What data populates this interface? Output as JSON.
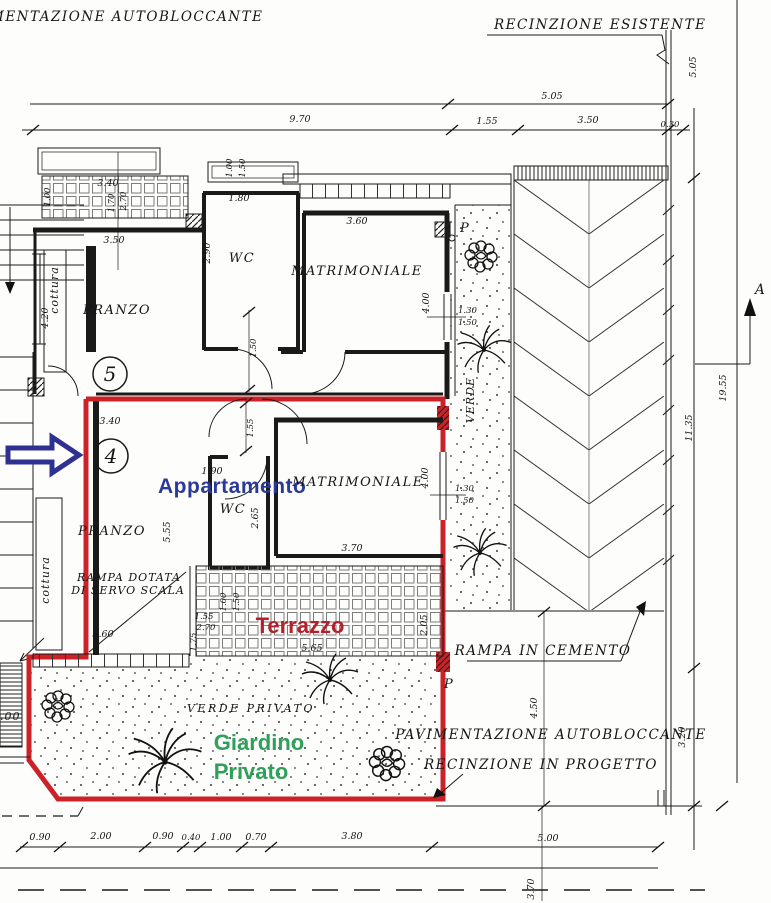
{
  "annotations": {
    "pavimentazione_top": "MENTAZIONE  AUTOBLOCCANTE",
    "recinzione_esistente": "RECINZIONE  ESISTENTE",
    "rampa_cemento": "RAMPA IN CEMENTO",
    "pavimentazione_autobloccante": "PAVIMENTAZIONE  AUTOBLOCCANTE",
    "recinzione_progetto": "RECINZIONE IN PROGETTO",
    "verde_privato": "VERDE  PRIVATO",
    "section_a": "A"
  },
  "apartment5": {
    "number": "5",
    "pranzo": "PRANZO",
    "wc": "WC",
    "matrimoniale": "MATRIMONIALE",
    "cottura": "cottura"
  },
  "apartment4": {
    "number": "4",
    "name": "Appartamento",
    "pranzo": "PRANZO",
    "wc": "WC",
    "matrimoniale": "MATRIMONIALE",
    "cottura": "cottura",
    "rampa1": "RAMPA DOTATA",
    "rampa2": "DI SERVO SCALA",
    "terrazzo": "Terrazzo",
    "giardino1": "Giardino",
    "giardino2": "Privato"
  },
  "markers": {
    "p": "P",
    "verde": "VERDE"
  },
  "dims": {
    "d030": "0.30",
    "d040": "0.40",
    "d070": "0.70",
    "d090": "0.90",
    "d100": "1.00",
    "d130": "1.30",
    "d150": "1.50",
    "d155": "1.55",
    "d170": "1.70",
    "d175": "1.75",
    "d180": "1.80",
    "d190": "1.90",
    "d200": "2.00",
    "d205": "2.05",
    "d265": "2.65",
    "d270": "2.70",
    "d290": "2.90",
    "d320": "3.20",
    "d340": "3.40",
    "d350": "3.50",
    "d360": "3.60",
    "d370": "3.70",
    "d380": "3.80",
    "d400": "4.00",
    "d420": "4.20",
    "d450": "4.50",
    "d500": "5.00",
    "d505": "5.05",
    "d555": "5.55",
    "d565": "5.65",
    "d970": "9.70",
    "d1135": "11.35",
    "d1955": "19.55"
  },
  "colors": {
    "red_outline": "#cc2127",
    "blue_text": "#2b3a99",
    "green_text": "#2fa05a",
    "terrazzo_red": "#b3212b",
    "arrow_blue": "#2e3192"
  }
}
